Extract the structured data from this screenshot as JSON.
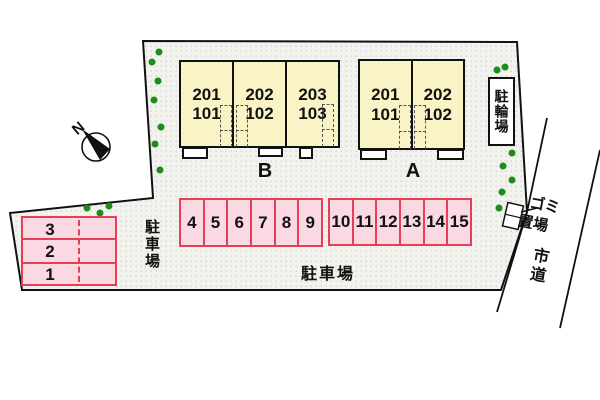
{
  "compass": {
    "label": "N"
  },
  "buildings": [
    {
      "name": "B",
      "units": [
        {
          "upper": "201",
          "lower": "101"
        },
        {
          "upper": "202",
          "lower": "102"
        },
        {
          "upper": "203",
          "lower": "103"
        }
      ]
    },
    {
      "name": "A",
      "units": [
        {
          "upper": "201",
          "lower": "101"
        },
        {
          "upper": "202",
          "lower": "102"
        }
      ]
    }
  ],
  "parking": {
    "left_block": [
      "3",
      "2",
      "1"
    ],
    "front_row": [
      "4",
      "5",
      "6",
      "7",
      "8",
      "9"
    ],
    "back_row": [
      "10",
      "11",
      "12",
      "13",
      "14",
      "15"
    ]
  },
  "labels": {
    "bicycle_parking": "駐輪場",
    "parking_area_left": "駐車場",
    "parking_area_bottom": "駐車場",
    "garbage_area": [
      "ゴミ",
      "置場"
    ],
    "city_road": "市道"
  },
  "colors": {
    "site_fill": "#F2F2EE",
    "site_dot": "#DCDCD6",
    "boundary": "#111111",
    "building_fill": "#FAF3C6",
    "parking_fill": "#FBD9E3",
    "parking_border": "#E63E54",
    "tree_green": "#1E8B1E"
  }
}
